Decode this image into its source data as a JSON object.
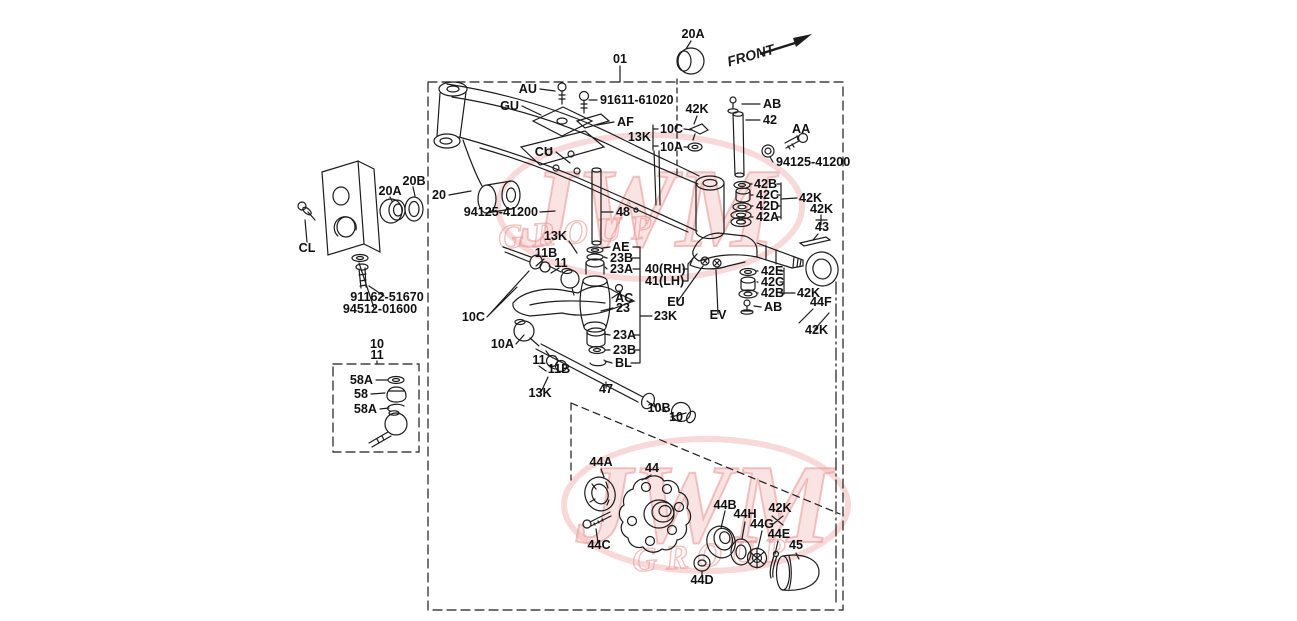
{
  "page": {
    "background": "#ffffff",
    "line_color": "#1c1c1c"
  },
  "watermark": {
    "text": "JWM",
    "subtext": "GROUP",
    "color": "#f0b6b6"
  },
  "front_indicator": {
    "label": "FRONT"
  },
  "diagram_labels": [
    {
      "text": "01",
      "x": 620,
      "y": 63,
      "anchor": "m"
    },
    {
      "text": "20A",
      "x": 693,
      "y": 38,
      "anchor": "m"
    },
    {
      "text": "FRONT-PLACEHOLDER-NOT-USED",
      "x": -100,
      "y": -100,
      "anchor": "m",
      "skip": true
    },
    {
      "text": "AU",
      "x": 537,
      "y": 93,
      "anchor": "e"
    },
    {
      "text": "91611-61020",
      "x": 600,
      "y": 104,
      "anchor": "s"
    },
    {
      "text": "GU",
      "x": 519,
      "y": 110,
      "anchor": "e"
    },
    {
      "text": "AF",
      "x": 617,
      "y": 126,
      "anchor": "s"
    },
    {
      "text": "CU",
      "x": 553,
      "y": 156,
      "anchor": "e"
    },
    {
      "text": "42K",
      "x": 697,
      "y": 113,
      "anchor": "m"
    },
    {
      "text": "AB",
      "x": 763,
      "y": 108,
      "anchor": "s"
    },
    {
      "text": "42",
      "x": 763,
      "y": 124,
      "anchor": "s"
    },
    {
      "text": "AA",
      "x": 792,
      "y": 133,
      "anchor": "s"
    },
    {
      "text": "94125-41200",
      "x": 776,
      "y": 166,
      "anchor": "s"
    },
    {
      "text": "13K",
      "x": 651,
      "y": 141,
      "anchor": "e"
    },
    {
      "text": "10C",
      "x": 660,
      "y": 133,
      "anchor": "s"
    },
    {
      "text": "10A",
      "x": 660,
      "y": 151,
      "anchor": "s"
    },
    {
      "text": "20B",
      "x": 414,
      "y": 185,
      "anchor": "m"
    },
    {
      "text": "20A",
      "x": 390,
      "y": 195,
      "anchor": "m"
    },
    {
      "text": "20",
      "x": 446,
      "y": 199,
      "anchor": "e"
    },
    {
      "text": "94125-41200",
      "x": 538,
      "y": 216,
      "anchor": "e"
    },
    {
      "text": "48",
      "x": 616,
      "y": 216,
      "anchor": "s"
    },
    {
      "text": "42B",
      "x": 754,
      "y": 188,
      "anchor": "s"
    },
    {
      "text": "42C",
      "x": 756,
      "y": 199,
      "anchor": "s"
    },
    {
      "text": "42D",
      "x": 756,
      "y": 210,
      "anchor": "s"
    },
    {
      "text": "42A",
      "x": 756,
      "y": 221,
      "anchor": "s"
    },
    {
      "text": "42K",
      "x": 799,
      "y": 202,
      "anchor": "s"
    },
    {
      "text": "42K",
      "x": 810,
      "y": 213,
      "anchor": "s"
    },
    {
      "text": "43",
      "x": 815,
      "y": 231,
      "anchor": "s"
    },
    {
      "text": "CL",
      "x": 307,
      "y": 252,
      "anchor": "m"
    },
    {
      "text": "13K",
      "x": 567,
      "y": 240,
      "anchor": "e"
    },
    {
      "text": "AE",
      "x": 612,
      "y": 251,
      "anchor": "s"
    },
    {
      "text": "23B",
      "x": 610,
      "y": 262,
      "anchor": "s"
    },
    {
      "text": "11B",
      "x": 546,
      "y": 257,
      "anchor": "m"
    },
    {
      "text": "11",
      "x": 561,
      "y": 267,
      "anchor": "m"
    },
    {
      "text": "23A",
      "x": 610,
      "y": 273,
      "anchor": "s"
    },
    {
      "text": "40(RH)",
      "x": 645,
      "y": 273,
      "anchor": "s"
    },
    {
      "text": "41(LH)",
      "x": 645,
      "y": 285,
      "anchor": "s"
    },
    {
      "text": "AC",
      "x": 615,
      "y": 302,
      "anchor": "s"
    },
    {
      "text": "23",
      "x": 616,
      "y": 312,
      "anchor": "s"
    },
    {
      "text": "23K",
      "x": 654,
      "y": 320,
      "anchor": "s"
    },
    {
      "text": "EU",
      "x": 676,
      "y": 306,
      "anchor": "m"
    },
    {
      "text": "EV",
      "x": 718,
      "y": 319,
      "anchor": "m"
    },
    {
      "text": "42E",
      "x": 761,
      "y": 275,
      "anchor": "s"
    },
    {
      "text": "42C",
      "x": 761,
      "y": 286,
      "anchor": "s"
    },
    {
      "text": "42B",
      "x": 761,
      "y": 297,
      "anchor": "s"
    },
    {
      "text": "42K",
      "x": 797,
      "y": 297,
      "anchor": "s"
    },
    {
      "text": "44F",
      "x": 810,
      "y": 306,
      "anchor": "s"
    },
    {
      "text": "AB",
      "x": 764,
      "y": 311,
      "anchor": "s"
    },
    {
      "text": "42K",
      "x": 805,
      "y": 334,
      "anchor": "s"
    },
    {
      "text": "91162-51670",
      "x": 387,
      "y": 301,
      "anchor": "m"
    },
    {
      "text": "94512-01600",
      "x": 380,
      "y": 313,
      "anchor": "m"
    },
    {
      "text": "10C",
      "x": 485,
      "y": 321,
      "anchor": "e"
    },
    {
      "text": "10A",
      "x": 514,
      "y": 348,
      "anchor": "e"
    },
    {
      "text": "23A",
      "x": 613,
      "y": 339,
      "anchor": "s"
    },
    {
      "text": "23B",
      "x": 613,
      "y": 354,
      "anchor": "s"
    },
    {
      "text": "BL",
      "x": 615,
      "y": 367,
      "anchor": "s"
    },
    {
      "text": "10",
      "x": 377,
      "y": 348,
      "anchor": "m"
    },
    {
      "text": "11",
      "x": 377,
      "y": 359,
      "anchor": "m"
    },
    {
      "text": "58A",
      "x": 373,
      "y": 384,
      "anchor": "e"
    },
    {
      "text": "58",
      "x": 368,
      "y": 398,
      "anchor": "e"
    },
    {
      "text": "58A",
      "x": 377,
      "y": 413,
      "anchor": "e"
    },
    {
      "text": "11",
      "x": 539,
      "y": 364,
      "anchor": "m"
    },
    {
      "text": "11B",
      "x": 559,
      "y": 373,
      "anchor": "m"
    },
    {
      "text": "13K",
      "x": 540,
      "y": 397,
      "anchor": "m"
    },
    {
      "text": "47",
      "x": 606,
      "y": 393,
      "anchor": "m"
    },
    {
      "text": "10B",
      "x": 659,
      "y": 412,
      "anchor": "m"
    },
    {
      "text": "10",
      "x": 676,
      "y": 421,
      "anchor": "m"
    },
    {
      "text": "44A",
      "x": 601,
      "y": 466,
      "anchor": "m"
    },
    {
      "text": "44",
      "x": 652,
      "y": 472,
      "anchor": "m"
    },
    {
      "text": "44C",
      "x": 599,
      "y": 549,
      "anchor": "m"
    },
    {
      "text": "44B",
      "x": 725,
      "y": 509,
      "anchor": "m"
    },
    {
      "text": "44H",
      "x": 745,
      "y": 518,
      "anchor": "m"
    },
    {
      "text": "42K",
      "x": 780,
      "y": 512,
      "anchor": "m"
    },
    {
      "text": "44G",
      "x": 762,
      "y": 528,
      "anchor": "m"
    },
    {
      "text": "44E",
      "x": 779,
      "y": 538,
      "anchor": "m"
    },
    {
      "text": "45",
      "x": 796,
      "y": 549,
      "anchor": "m"
    },
    {
      "text": "44D",
      "x": 702,
      "y": 584,
      "anchor": "m"
    }
  ]
}
